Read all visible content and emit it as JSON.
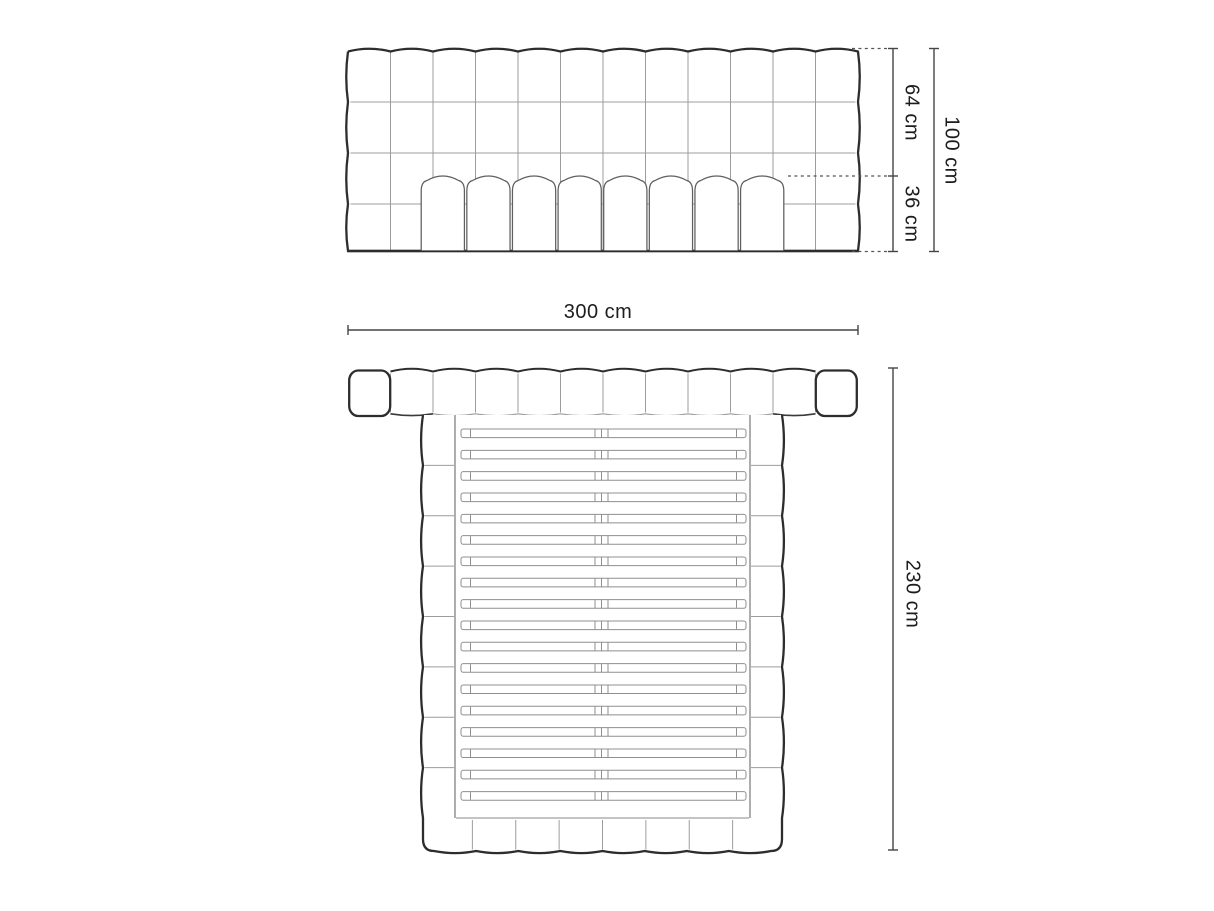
{
  "page": {
    "type": "product dimension diagram",
    "product": "upholstered bed with tufted headboard, mattress and slatted frame",
    "background": "#ffffff"
  },
  "labels": {
    "headboard_upper_height": "64 cm",
    "lower_height": "36 cm",
    "total_height": "100 cm",
    "total_width": "300 cm",
    "total_depth": "230 cm"
  },
  "front_view": {
    "headboard_columns": 12,
    "headboard_rows": 4,
    "mattress_columns": 8
  },
  "plan_view": {
    "headboard_segments": 12,
    "side_rail_segments": 8,
    "footboard_segments": 8,
    "slat_rows": 18,
    "slats_per_row": 2
  },
  "colors": {
    "outline": "#2d2d2d",
    "medium": "#5f5f5f",
    "grid": "#9c9c9c",
    "slat": "#8f8f8f",
    "dimension": "#454545",
    "dotted": "#555555",
    "text": "#1d1d1d",
    "background": "#ffffff"
  }
}
